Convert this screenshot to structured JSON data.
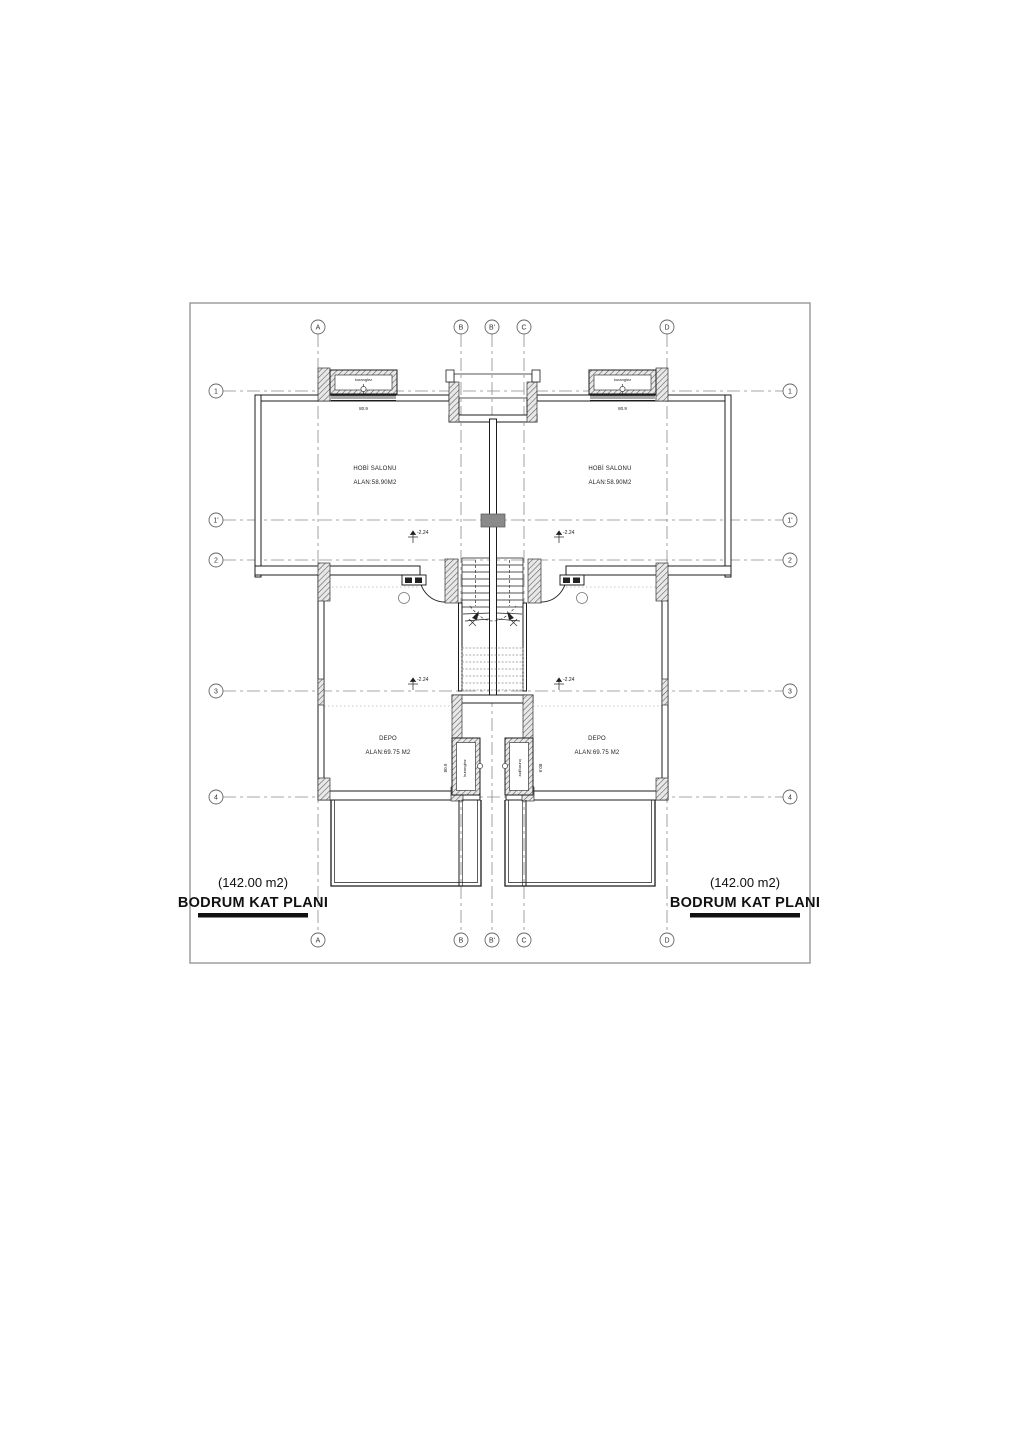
{
  "document": {
    "kind": "architectural floor plan",
    "floor_title": "BODRUM KAT PLANI",
    "floor_area": "(142.00 m2)"
  },
  "axes": {
    "vertical": {
      "a": "A",
      "b": "B",
      "b_prime": "B'",
      "c": "C",
      "d": "D"
    },
    "horizontal": {
      "n1": "1",
      "n1_prime": "1'",
      "n2": "2",
      "n3": "3",
      "n4": "4"
    }
  },
  "rooms": {
    "hobby": {
      "name": "HOBİ SALONU",
      "area": "ALAN:58.90M2"
    },
    "depo": {
      "name": "DEPO",
      "area": "ALAN:69.75 M2"
    }
  },
  "annotations": {
    "window_well": "kuranglez",
    "window_dim": "80.9",
    "elevation": "-2.24"
  },
  "title_block": {
    "area": "(142.00 m2)",
    "title": "BODRUM KAT PLANI"
  },
  "colors": {
    "line": "#1c1c1c",
    "grid": "#8a8a8a",
    "frame": "#9e9e9e",
    "hatch": "#555555",
    "background": "#ffffff"
  }
}
